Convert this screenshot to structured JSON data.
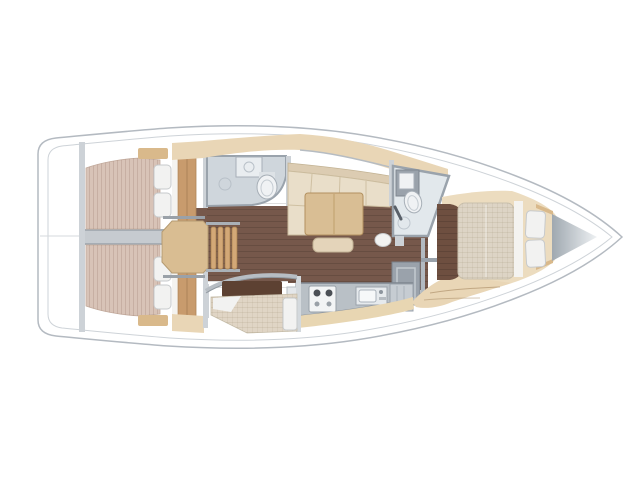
{
  "title": "sailboat-interior-floorplan",
  "view": "top-down",
  "bow_direction": "right",
  "areas": [
    "aft-deck",
    "aft-cabin-port",
    "aft-cabin-starboard",
    "engine-compartment",
    "companionway-steps",
    "aft-head",
    "salon",
    "galley",
    "starboard-berth",
    "forward-head",
    "forward-cabin",
    "bow-locker"
  ],
  "colors": {
    "hull_line": "#b4bac1",
    "inner_line": "#ced3d8",
    "wall_gray": "#9aa3ac",
    "wall_light": "#cdd2d7",
    "engine_gray": "#c6cbd0",
    "floor_wood": "#76584b",
    "entrance_wood": "#6e4f40",
    "mattress_aft": "#d8c3b7",
    "mattress_fwd": "#ddd4c5",
    "mattress_settee": "#e0d5c5",
    "pillow": "#f2f2f1",
    "pillow_border": "#c7cacc",
    "headboard": "#f4f3f0",
    "sofa_back": "#dcccb2",
    "sofa_seat": "#e9dec9",
    "table_wood": "#d9be94",
    "stool": "#e4d4ba",
    "step_wood": "#d3a877",
    "platform_wood": "#d9bd92",
    "cabinet_beige": "#e9d6b6",
    "cabinet_beige_light": "#ecdcbf",
    "cabinet_tan": "#d9b98b",
    "wardrobe_wood": "#c89b6d",
    "bath_floor": "#cfd6dc",
    "bath_floor_fwd": "#e2e8ec",
    "counter_gray": "#b9c0c6",
    "appliance_white": "#f2f4f5",
    "locker_gray": "#9aa2ab",
    "dark_opening": "#5d4132",
    "fixture_white": "#f0f2f4",
    "galley_face": "#e8d6b2",
    "hull_fill": "#ffffff"
  }
}
